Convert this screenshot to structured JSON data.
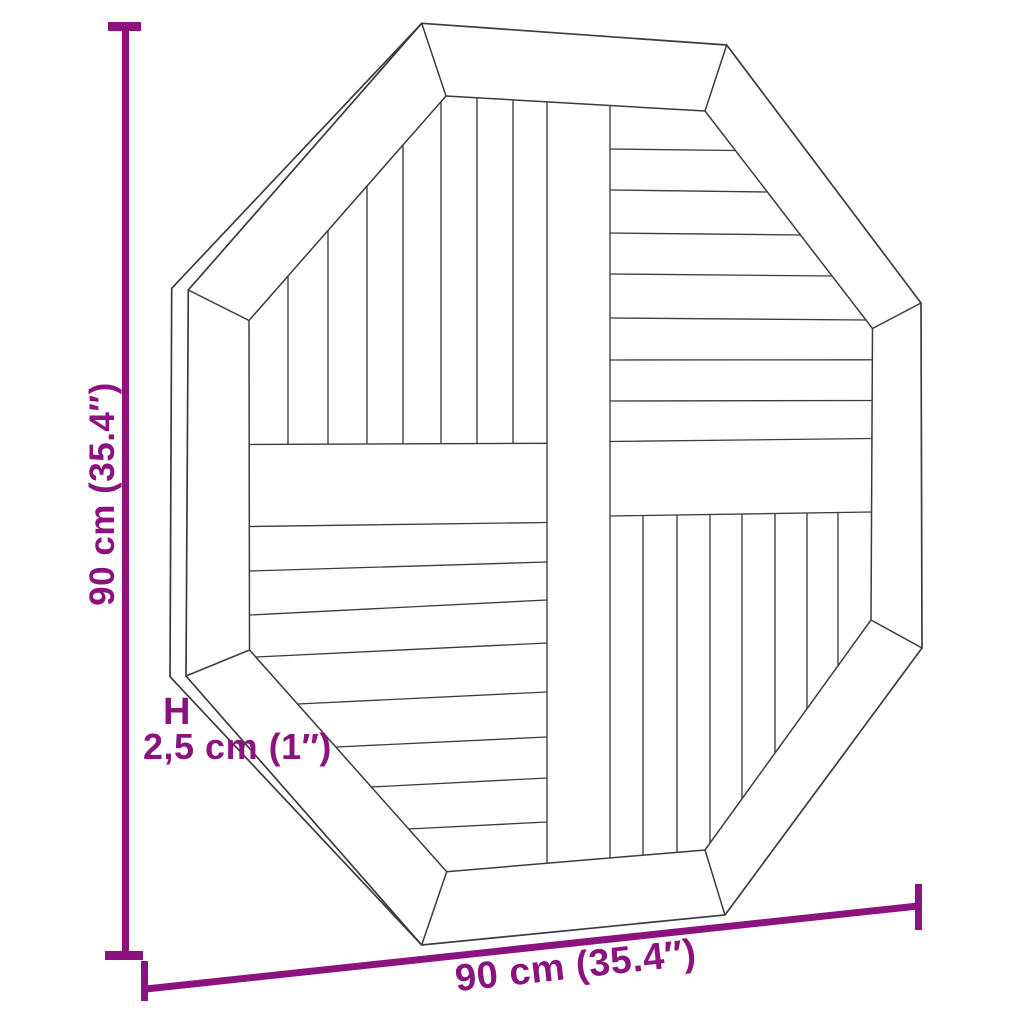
{
  "figure": {
    "subject": "octagonal slatted tabletop, top view line drawing"
  },
  "colors": {
    "accent": "#8C1280",
    "line": "#3C3C3C",
    "background": "#FFFFFF"
  },
  "dimensions": {
    "height": {
      "value": "90 cm (35.4″)"
    },
    "width": {
      "value": "90 cm (35.4″)"
    },
    "thickness": {
      "symbol": "H",
      "value": "2,5 cm (1″)"
    }
  }
}
